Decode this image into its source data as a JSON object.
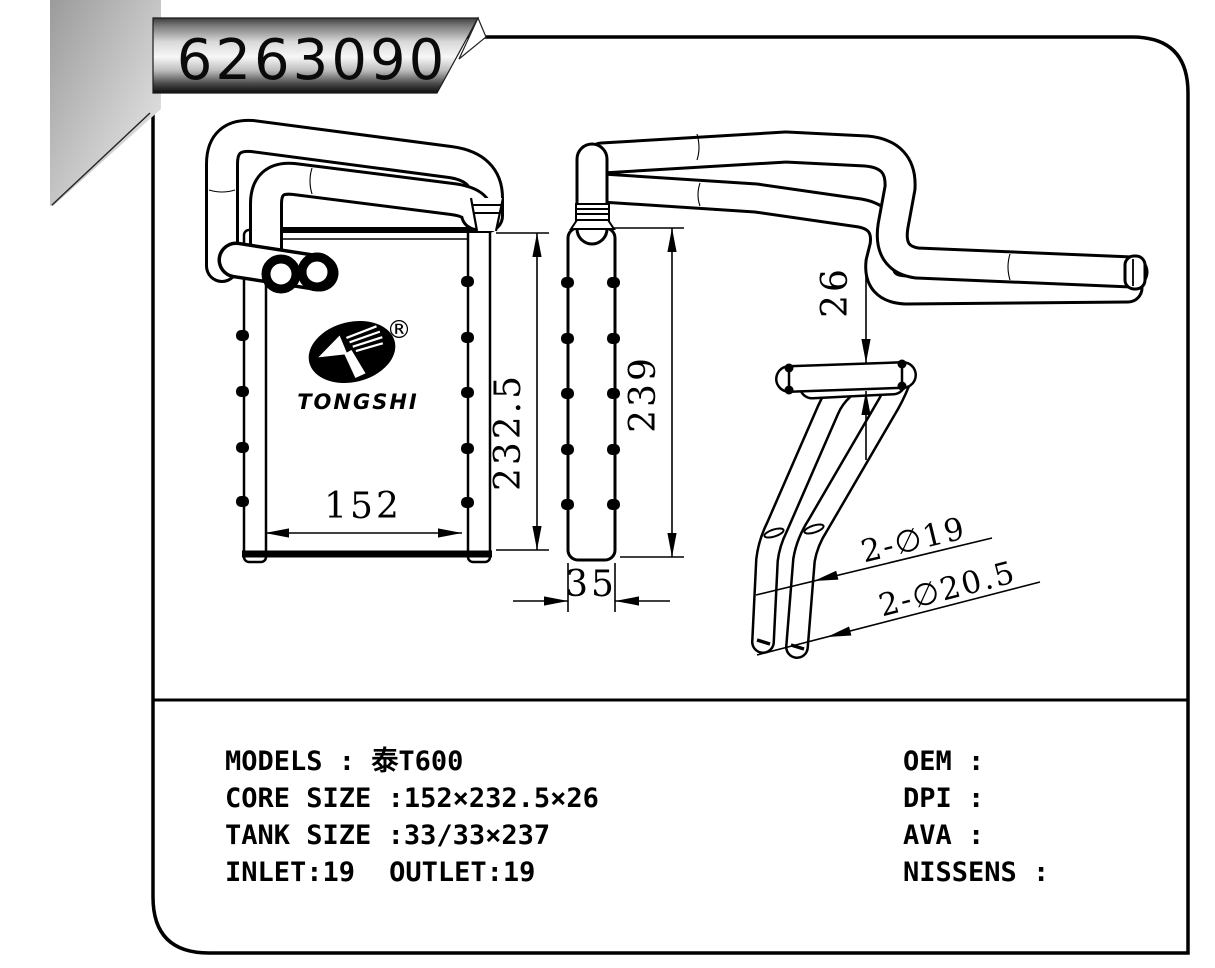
{
  "banner": {
    "part_number": "6263090"
  },
  "logo": {
    "brand": "TONGSHI",
    "registered_mark": "®"
  },
  "dimensions": {
    "core_width": "152",
    "core_height": "232.5",
    "tank_height": "239",
    "tank_depth": "35",
    "pipe_offset": "26",
    "pipe_dia_inner": "2-∅19",
    "pipe_dia_outer": "2-∅20.5"
  },
  "specs": {
    "rows": [
      {
        "label": "MODELS",
        "sep": " : ",
        "value": "泰T600"
      },
      {
        "label": "CORE SIZE",
        "sep": " :",
        "value": "152×232.5×26"
      },
      {
        "label": "TANK SIZE",
        "sep": " :",
        "value": "33/33×237"
      }
    ],
    "flow": {
      "inlet_label": "INLET",
      "inlet_sep": ":",
      "inlet_value": "19",
      "outlet_label": "OUTLET",
      "outlet_sep": ":",
      "outlet_value": "19"
    },
    "right_rows": [
      {
        "label": "OEM",
        "sep": " :"
      },
      {
        "label": "DPI",
        "sep": " :"
      },
      {
        "label": "AVA",
        "sep": " :"
      },
      {
        "label": "NISSENS",
        "sep": " :"
      }
    ]
  },
  "colors": {
    "line": "#000000",
    "background": "#ffffff",
    "fold_gray": "#9b9b9b",
    "banner_dark": "#0d0d0d"
  }
}
